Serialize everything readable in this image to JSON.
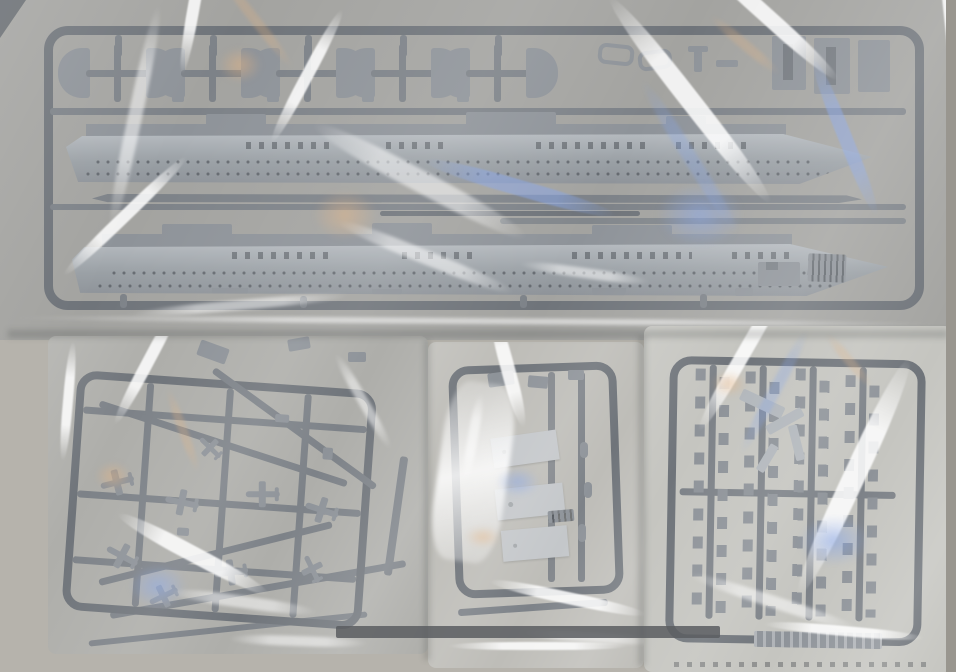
{
  "meta": {
    "domain": "natural-image",
    "description": "Top-down photograph of an unassembled grey plastic scale-model warship kit: four injection-moulded sprues (parts trees) sealed in clear polyethylene bags lying on a grey-beige surface. The large top sprue holds two long aircraft-carrier hull halves, a row of fan-shaped gun sponson platforms, link fittings and rectangular blocks. Below are three smaller bagged sprues: left holds miniature carrier aircraft in a lattice of runners, centre holds three flat deck/elevator panels, right holds dense columns of small armament fittings with a moulded label tab. Strong white, blue and warm specular creases from the plastic film cross every bag.",
    "visible_text": "none"
  },
  "palette": {
    "bg": "#b6b3ac",
    "bgEdge": "#99968f",
    "bagTopFill": "#a3a3a0",
    "bagLeftFill": "#aeaeaa",
    "bagMidFill": "#bebdb8",
    "bagRightFill": "#c5c5c0",
    "frame": "#6f747a",
    "runner": "#7d8288",
    "part": "#8e9399",
    "partLight": "#b2b7bc",
    "hull": "#9aa0a5",
    "hullLight": "#b4b9be",
    "panel": "#c4c7ca",
    "dotc": "#565b61",
    "darkA": "rgba(52,57,63,0.55)",
    "dark": "#5a5d60",
    "hlStrong": "rgba(255,255,255,0.95)",
    "hlSoft": "rgba(255,255,255,0.55)",
    "tintBlueA": "rgba(132,164,234,0.55)",
    "tintWarmA": "rgba(228,178,128,0.5)",
    "shadow": "rgba(40,42,46,0.18)"
  },
  "objects": {
    "top_bag": {
      "label": "large clear bag with main sprue",
      "sprue_color_name": "medium grey",
      "parts": [
        "ship hull half (upper, bow pointing right)",
        "ship hull half (lower, bow pointing right)",
        "fan-shaped gun sponson platforms x10 in 5 pairs with cross runners",
        "oval link fittings x2",
        "rectangular slotted blocks x3",
        "long thin waterline plate",
        "thin rod",
        "ribbed grille blocks x2"
      ]
    },
    "left_bag": {
      "label": "bag with aircraft sprue, slightly rotated",
      "parts": [
        "miniature aircraft x9",
        "lattice of diagonal and straight runners",
        "small fittings"
      ]
    },
    "middle_bag": {
      "label": "bag with flat panel sprue, heavy white film creases",
      "parts": [
        "flat rectangular deck/elevator panels x3",
        "ribbed mini block",
        "small cylinders",
        "rounded runner frame"
      ]
    },
    "right_bag": {
      "label": "bag with fittings sprue",
      "parts": [
        "four vertical runners with columns of tiny armament fittings",
        "loose cluster of parts near centre-top",
        "moulded label tab at bottom"
      ]
    },
    "surface": "grey-beige tabletop, darker right edge, dark band near bottom centre"
  }
}
